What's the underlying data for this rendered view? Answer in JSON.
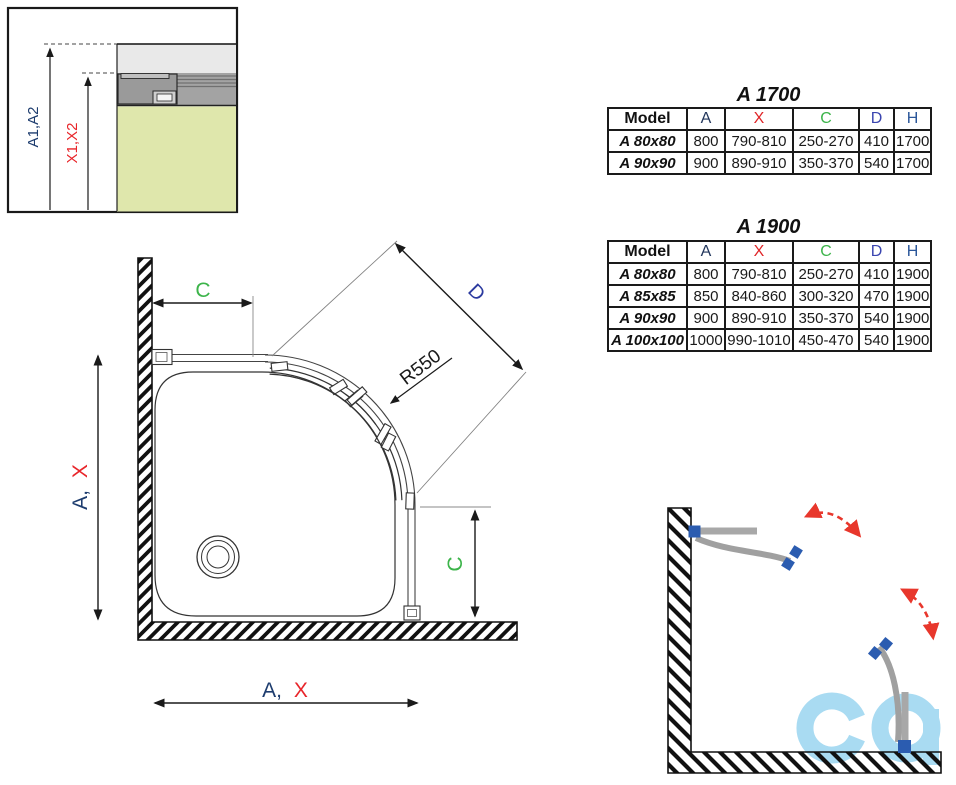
{
  "detail_section": {
    "label_a": "A1,A2",
    "label_x": "X1,X2"
  },
  "plan": {
    "dim_c_top": "C",
    "dim_d": "D",
    "radius_label": "R550",
    "dim_left_a": "A,",
    "dim_left_x": "X",
    "dim_right_c": "C",
    "dim_bottom_a": "A,",
    "dim_bottom_x": "X"
  },
  "tables": [
    {
      "title": "A 1700",
      "headers": [
        "Model",
        "A",
        "X",
        "C",
        "D",
        "H"
      ],
      "rows": [
        {
          "cells": [
            "A 80x80",
            "800",
            "790-810",
            "250-270",
            "410",
            "1700"
          ]
        },
        {
          "cells": [
            "A 90x90",
            "900",
            "890-910",
            "350-370",
            "540",
            "1700"
          ]
        }
      ]
    },
    {
      "title": "A 1900",
      "headers": [
        "Model",
        "A",
        "X",
        "C",
        "D",
        "H"
      ],
      "rows": [
        {
          "cells": [
            "A 80x80",
            "800",
            "790-810",
            "250-270",
            "410",
            "1900"
          ]
        },
        {
          "cells": [
            "A 85x85",
            "850",
            "840-860",
            "300-320",
            "470",
            "1900"
          ]
        },
        {
          "cells": [
            "A 90x90",
            "900",
            "890-910",
            "350-370",
            "540",
            "1900"
          ]
        },
        {
          "cells": [
            "A 100x100",
            "1000",
            "990-1010",
            "450-470",
            "540",
            "1900"
          ]
        }
      ]
    }
  ],
  "colors": {
    "dim_red": "#e8252a",
    "dim_green": "#3cb44a",
    "dim_navy": "#1d3c6e",
    "dim_indigo": "#2b3a9f",
    "header_blue": "#2b579a",
    "door_blue": "#2b5cb0",
    "door_gray": "#a0a0a0",
    "arrow_red": "#e8372c",
    "watermark_blue": "#a9dbf2",
    "tray_fill": "#dfe7ac",
    "glass_fill": "#e9e9e9",
    "profile_fill": "#a3a3a3"
  },
  "watermark": {
    "name": "co-logo"
  }
}
